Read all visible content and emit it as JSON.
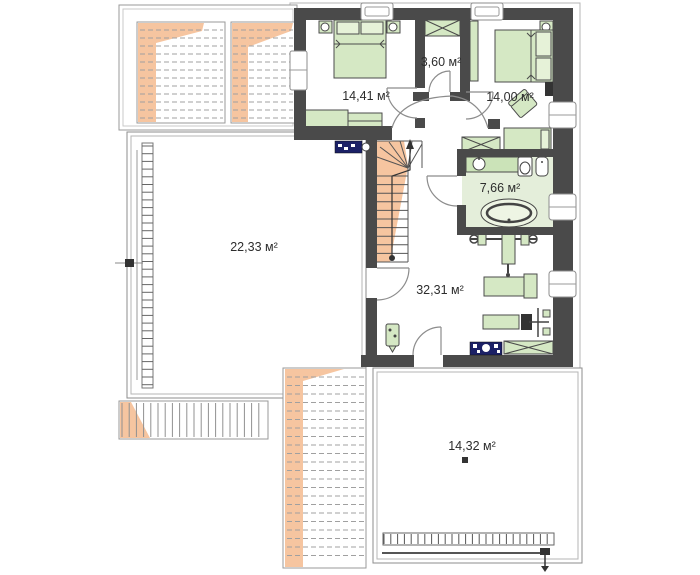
{
  "plan": {
    "type": "floor-plan-upper-storey",
    "rooms": [
      {
        "name": "bedroom-left",
        "label": "14,41 м²"
      },
      {
        "name": "wardrobe-room",
        "label": "3,60 м²"
      },
      {
        "name": "bedroom-right",
        "label": "14,00 м²"
      },
      {
        "name": "bathroom",
        "label": "7,66 м²"
      },
      {
        "name": "terrace-left",
        "label": "22,33 м²"
      },
      {
        "name": "hall",
        "label": "32,31 м²"
      },
      {
        "name": "terrace-bottom",
        "label": "14,32 м²"
      }
    ],
    "colors": {
      "wall": "#4a4a4a",
      "furniture_green": "#d5e8c4",
      "bathroom_floor": "#e4eeda",
      "roof_orange": "#f6c5a0",
      "electrical_panel_navy": "#1b2066",
      "outline_gray": "#9a9a9a"
    }
  }
}
